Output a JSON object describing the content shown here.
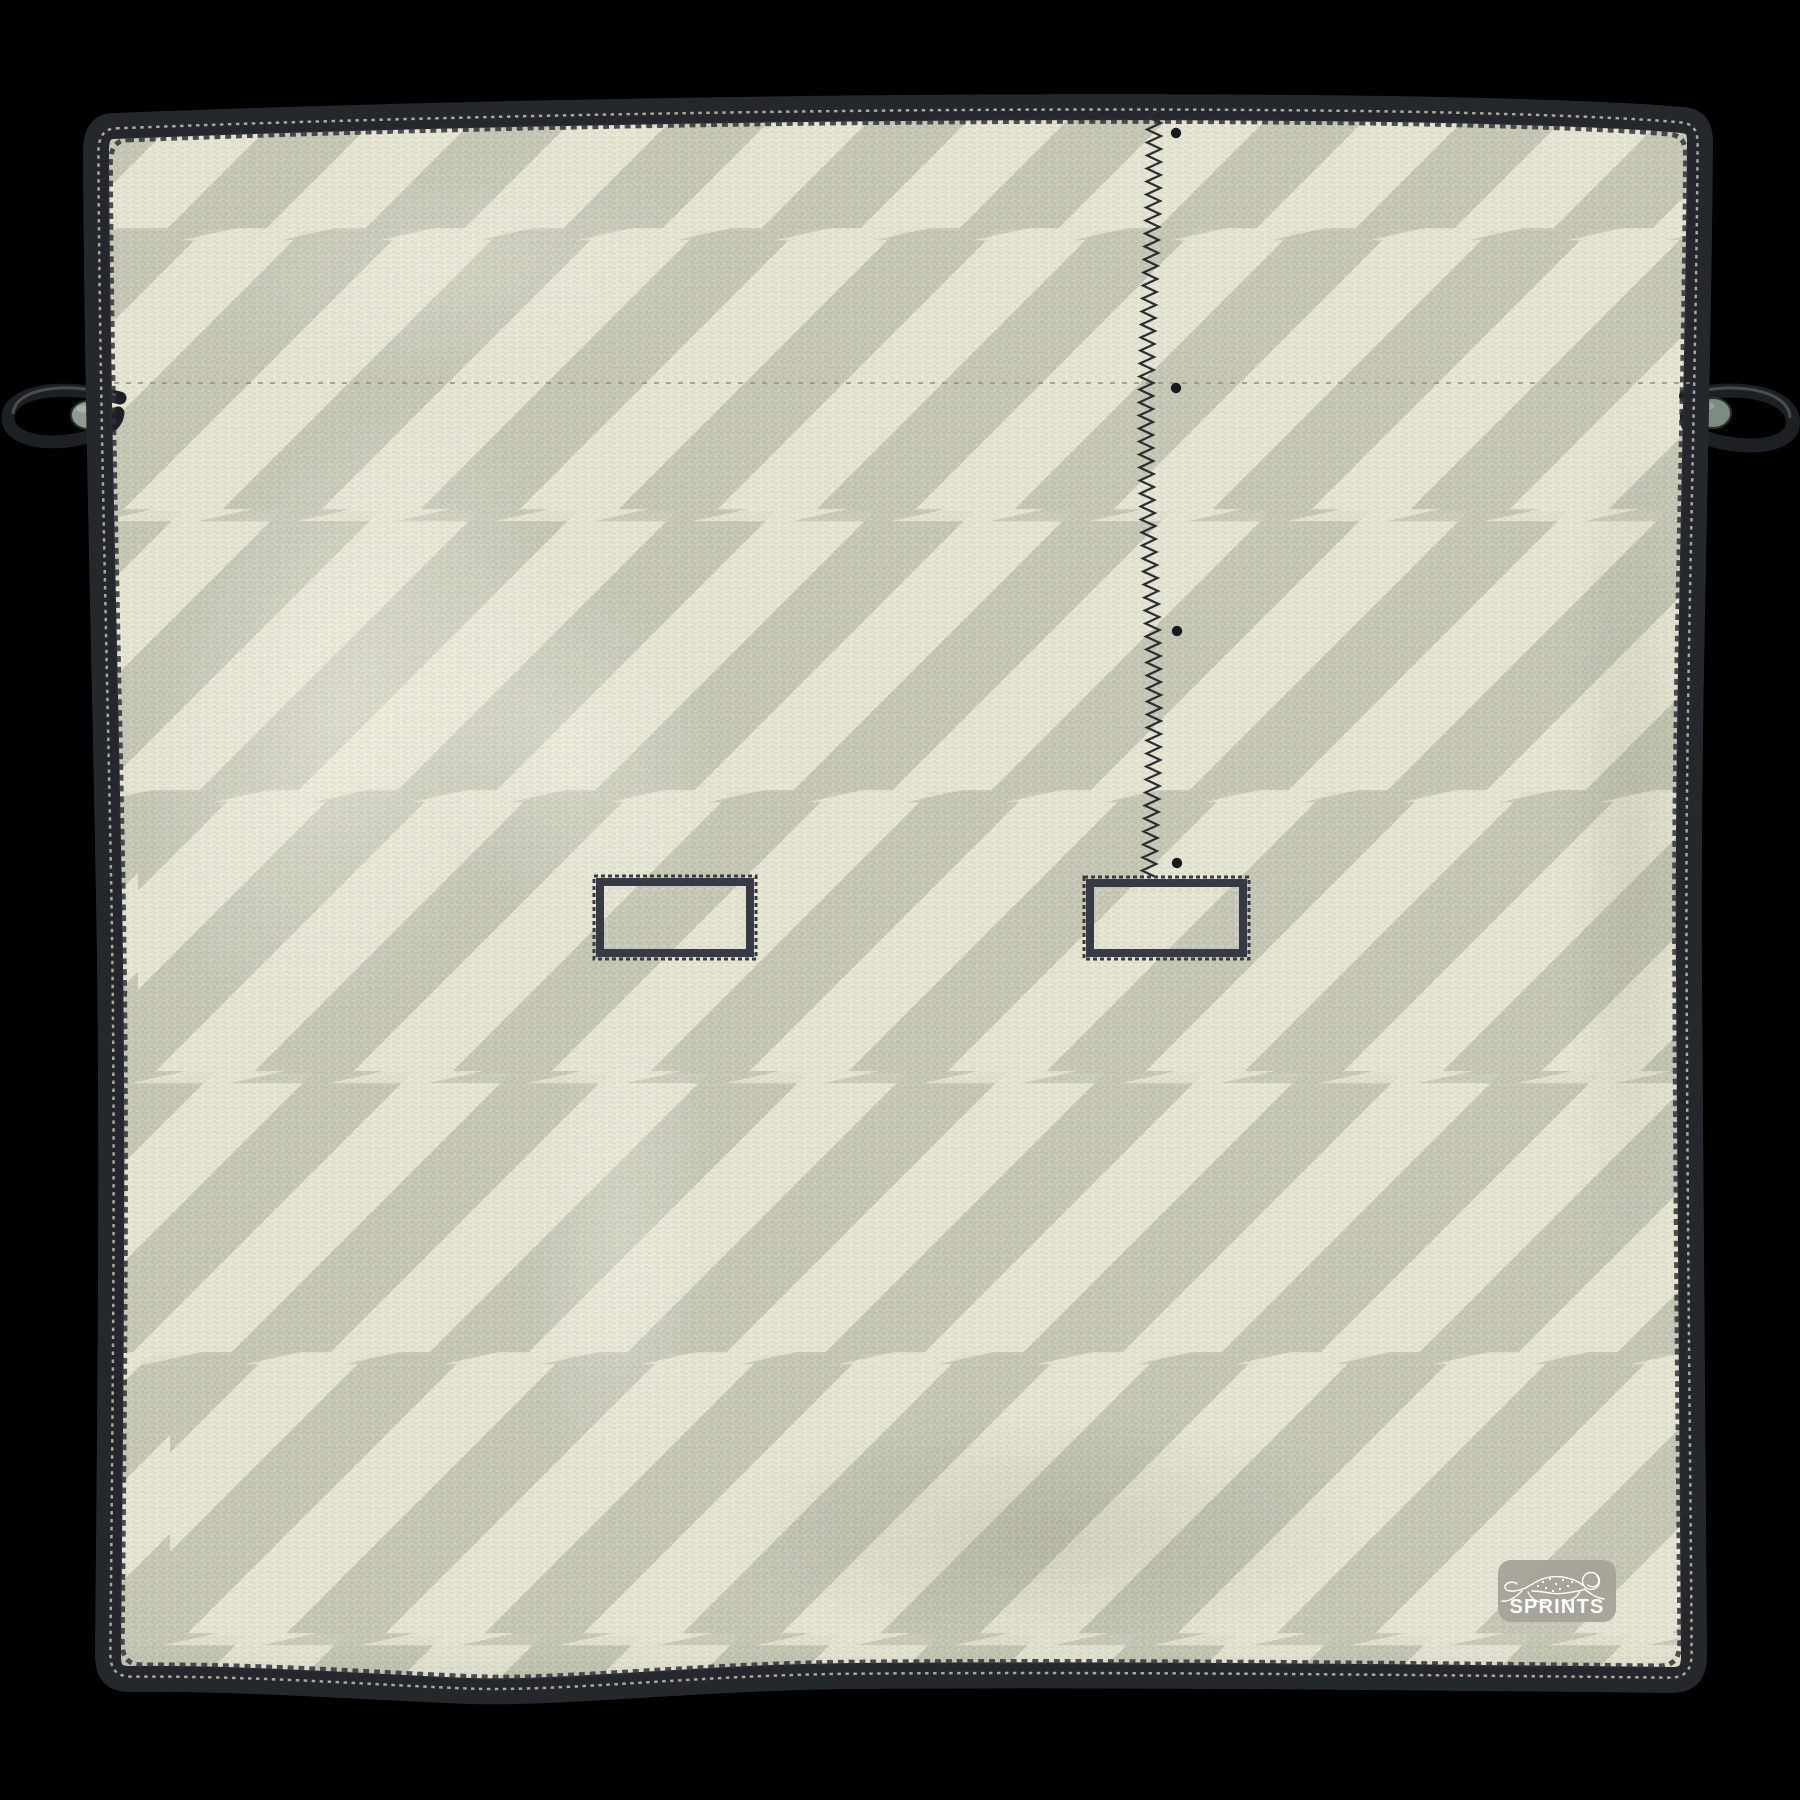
{
  "badge": {
    "label": "SPRINTS",
    "icon": "cheetah-icon",
    "background": "#a5a399",
    "text_color": "#ffffff"
  },
  "colors": {
    "page_background": "#000000",
    "stripe_light": "#e9e8d6",
    "stripe_dark": "#c7c8b6",
    "edge_band": "#24272c",
    "edge_stitch_dark": "#2f333a",
    "edge_stitch_light": "#c9cabb",
    "seam_dash": "#97937e",
    "zigzag_stitch": "#2b2e35",
    "dot": "#17191d",
    "buttonhole_border": "#363a45",
    "buttonhole_inner_dash": "#d6d5c6",
    "cord": "#1c1f23",
    "cord_highlight": "#474d52",
    "toggle_left": "#8d9c90",
    "toggle_right": "#7b8c81",
    "toggle_rim": "#2c3231"
  },
  "features": {
    "stripe": {
      "angle_deg": 45,
      "stripe_width_px": 70,
      "bolt_row_period_px": 281,
      "bolt_rows_y": [
        230,
        511,
        792,
        1073,
        1354,
        1635
      ]
    },
    "seam_line": {
      "y": 383,
      "x_start": 114,
      "x_end": 1690
    },
    "zigzag_stitch": {
      "x_center": 1150,
      "y_top": 110,
      "y_bottom": 881
    },
    "dots": [
      {
        "x": 1176,
        "y": 133
      },
      {
        "x": 1176,
        "y": 388
      },
      {
        "x": 1177,
        "y": 631
      },
      {
        "x": 1177,
        "y": 863
      }
    ],
    "buttonholes": [
      {
        "x": 600,
        "y": 882,
        "w": 150,
        "h": 71
      },
      {
        "x": 1090,
        "y": 883,
        "w": 153,
        "h": 70
      }
    ],
    "badge_box": {
      "x": 1498,
      "y": 1560,
      "w": 118,
      "h": 62,
      "radius": 13
    },
    "corner_loops": [
      {
        "side": "left"
      },
      {
        "side": "right"
      }
    ]
  }
}
